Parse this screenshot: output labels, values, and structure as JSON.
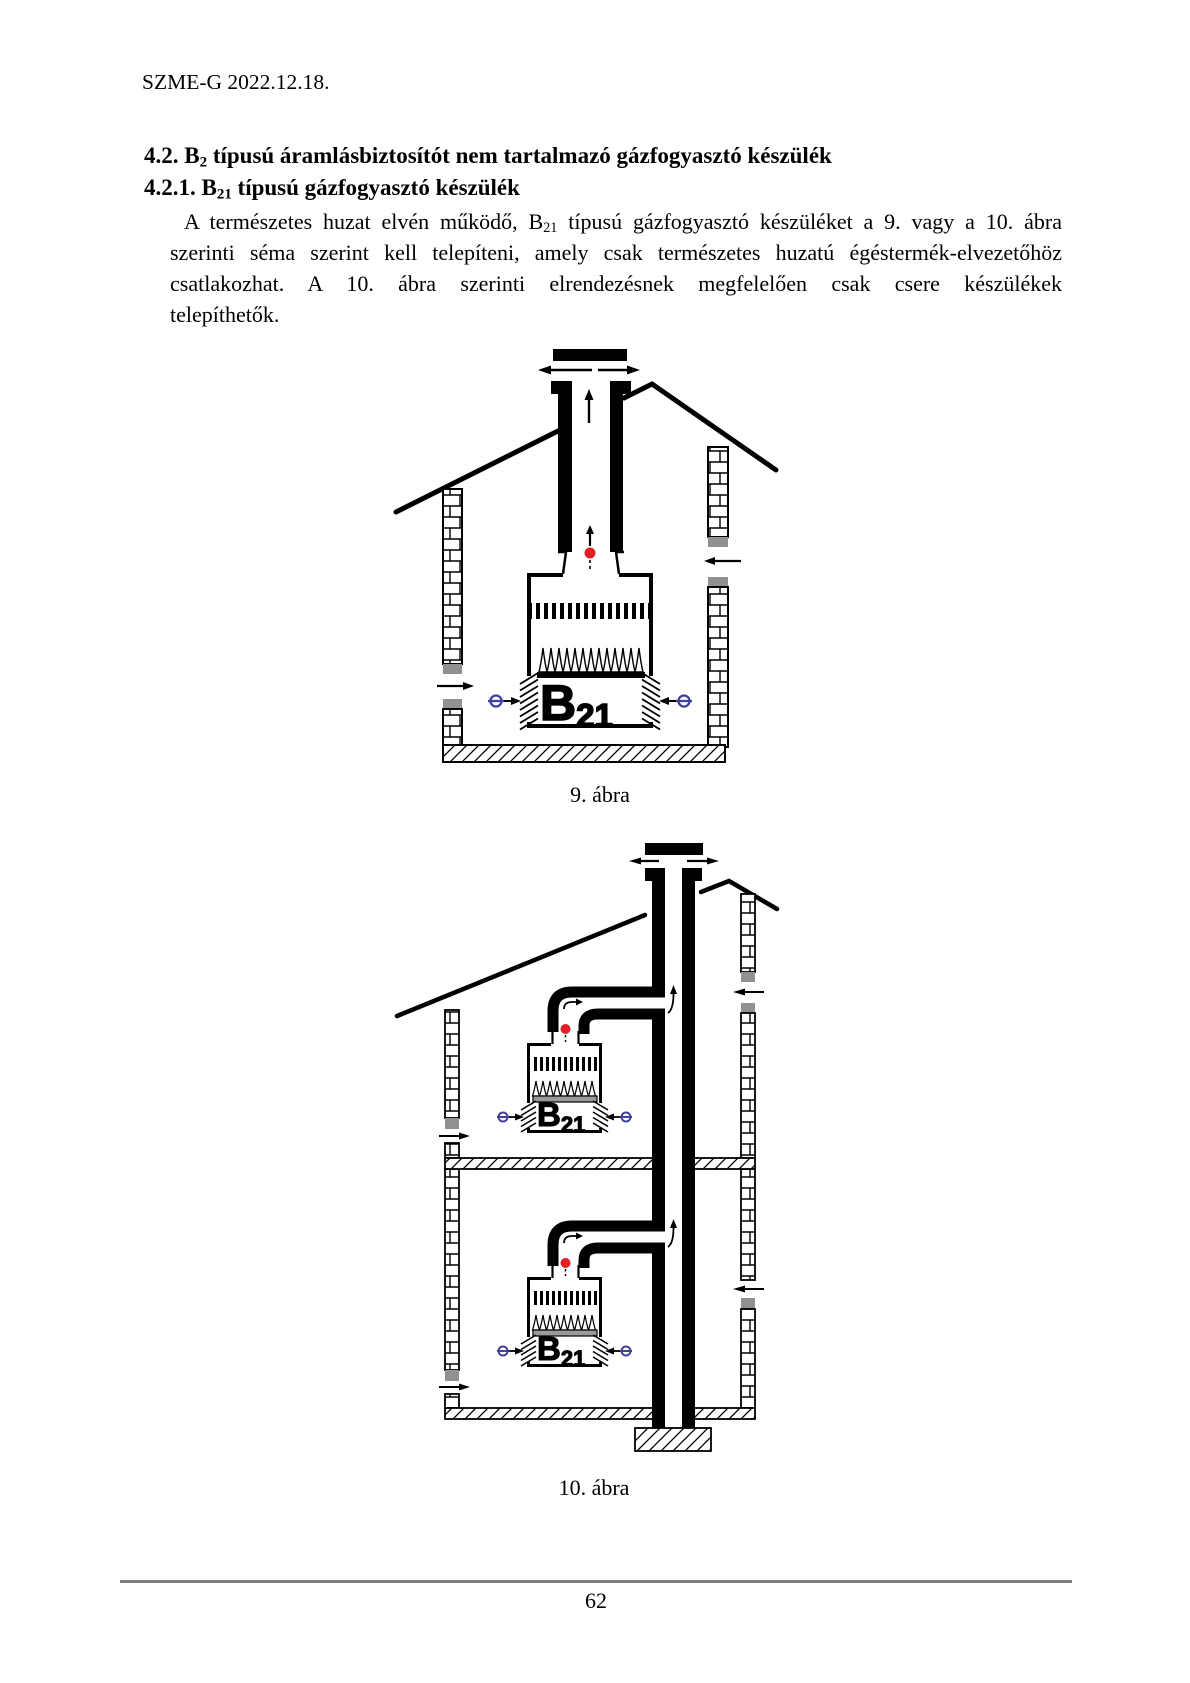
{
  "page": {
    "header": "SZME-G 2022.12.18.",
    "footer_page_number": "62"
  },
  "headings": {
    "h42": {
      "prefix": "4.2. B",
      "sub": "2",
      "rest": " típusú áramlásbiztosítót nem tartalmazó gázfogyasztó készülék"
    },
    "h421": {
      "prefix": "4.2.1. B",
      "sub": "21",
      "rest": " típusú gázfogyasztó készülék"
    }
  },
  "paragraph": {
    "line1_pre": "A természetes huzat elvén működő, B",
    "line1_sub": "21",
    "line1_post": " típusú gázfogyasztó készüléket a 9. vagy a 10. ábra",
    "line2": "szerinti séma szerint kell telepíteni, amely csak természetes huzatú égéstermék-elvezetőhöz",
    "line3": "csatlakozhat. A 10. ábra szerinti elrendezésnek megfelelően csak csere készülékek",
    "line4": "telepíthetők."
  },
  "figures": {
    "fig9": {
      "caption": "9. ábra",
      "appliance_label_main": "B",
      "appliance_label_sub": "21"
    },
    "fig10": {
      "caption": "10. ábra",
      "upper_label_main": "B",
      "upper_label_sub": "21",
      "lower_label_main": "B",
      "lower_label_sub": "21"
    }
  },
  "colors": {
    "flue_gas_red": "#e31e25",
    "air_inlet_blue": "#41419b",
    "wall_gray": "#919191",
    "footer_line_gray": "#7d7d7d"
  }
}
